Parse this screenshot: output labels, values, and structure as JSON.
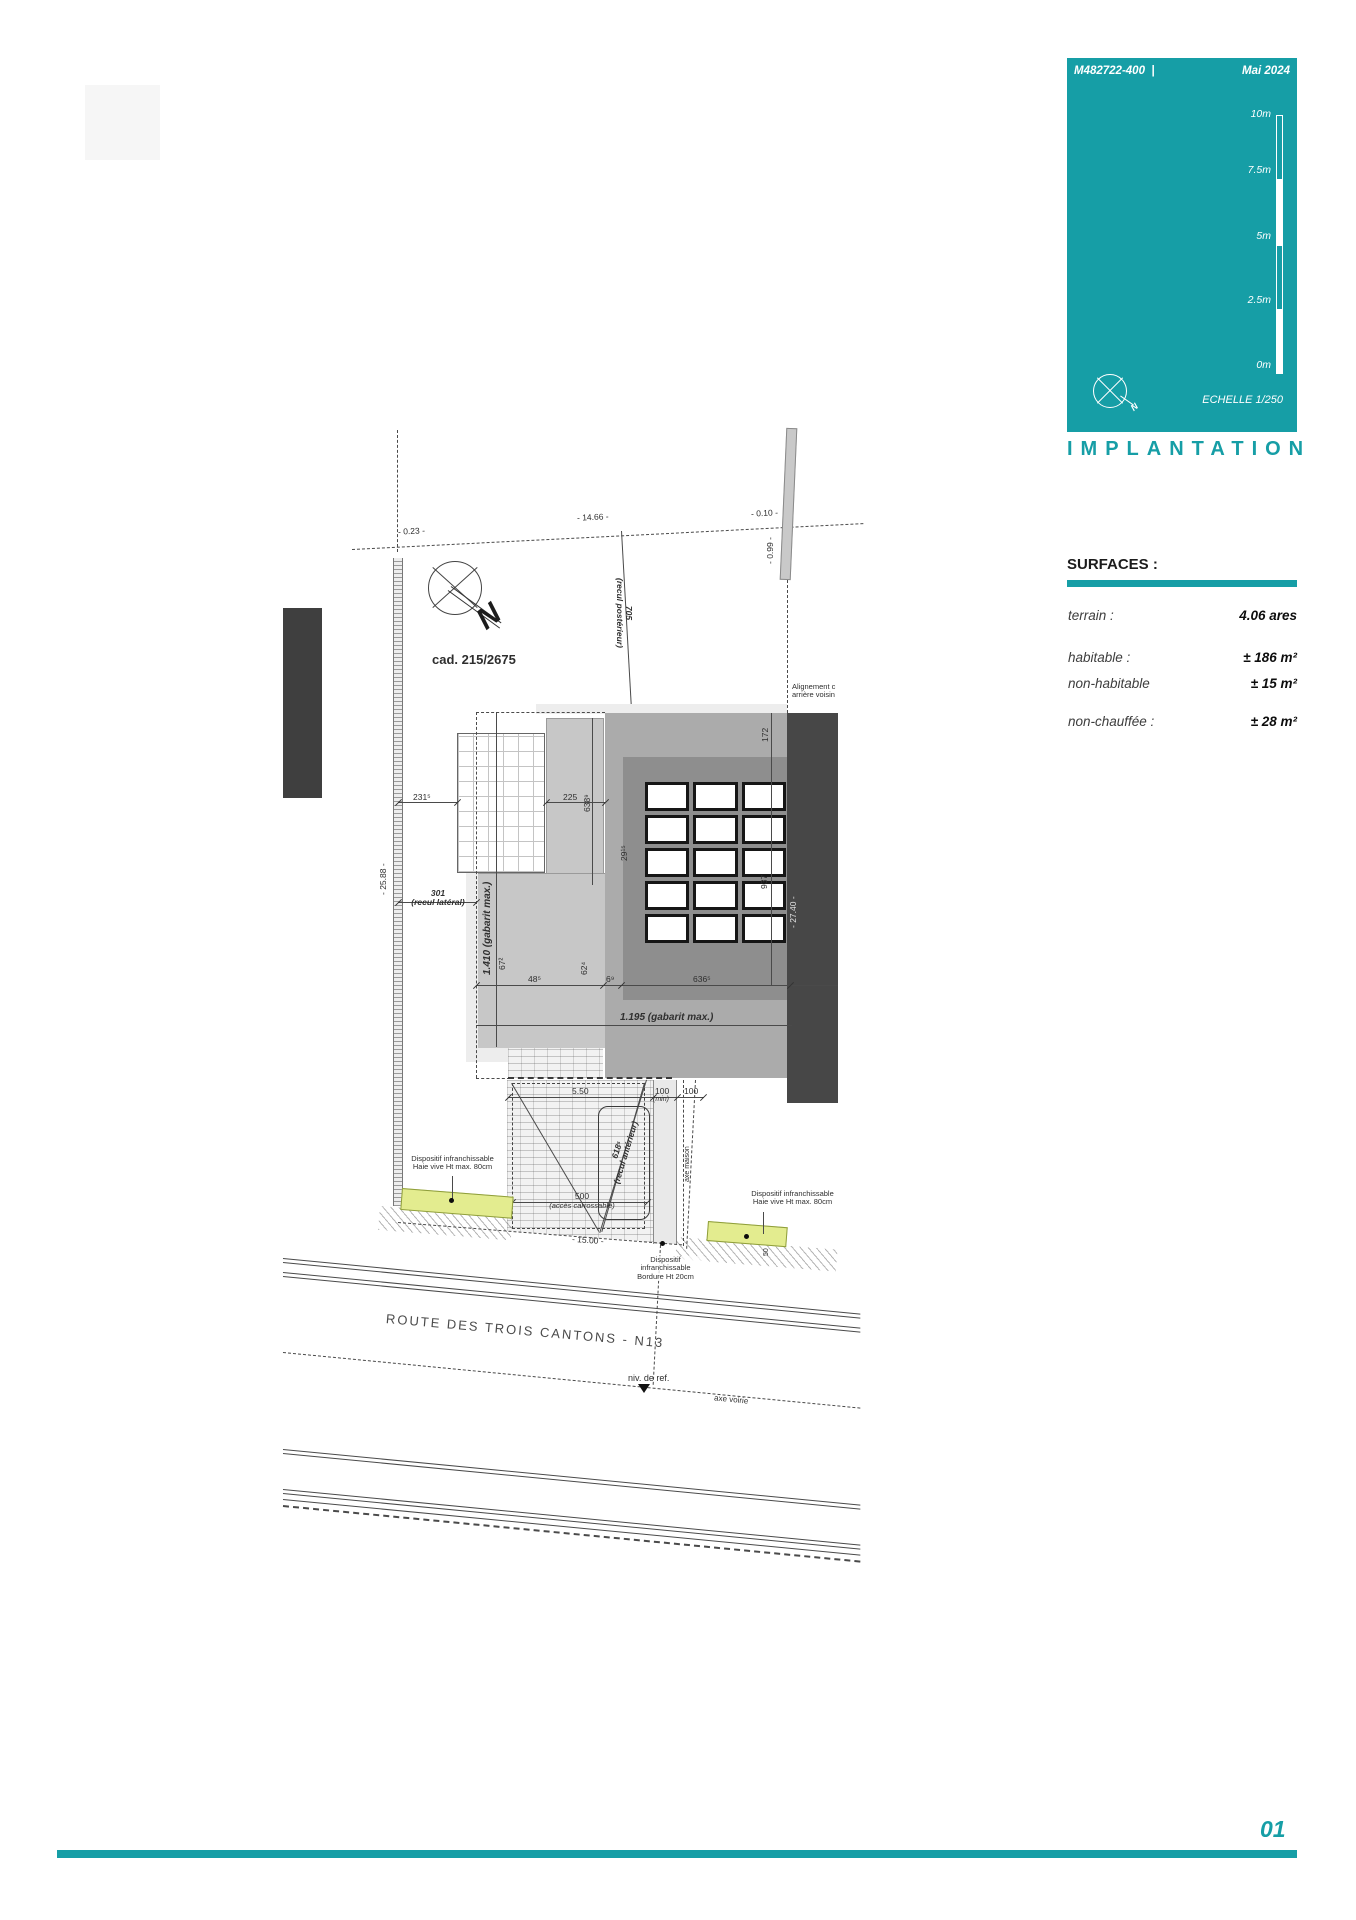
{
  "accent_color": "#169ea6",
  "header": {
    "ref": "M482722-400",
    "separator": "|",
    "date": "Mai 2024",
    "scale_label": "ECHELLE  1/250",
    "title": "IMPLANTATION",
    "page_number": "01"
  },
  "scale_bar": {
    "labels": [
      "10m",
      "7.5m",
      "5m",
      "2.5m",
      "0m"
    ]
  },
  "surfaces": {
    "heading": "SURFACES :",
    "rows": [
      {
        "label": "terrain :",
        "value": "4.06 ares"
      },
      {
        "label": "habitable :",
        "value": "± 186 m²"
      },
      {
        "label": "non-habitable",
        "value": "± 15 m²"
      },
      {
        "label": "non-chauffée :",
        "value": "± 28 m²"
      }
    ]
  },
  "plan": {
    "north_letter": "N",
    "cadastre": "cad. 215/2675",
    "d023": "- 0.23 -",
    "d1466": "- 14.66 -",
    "d010": "- 0.10 -",
    "d099": "- 0.99 -",
    "d2588": "- 25.88 -",
    "d705": "705",
    "recul_posterieur": "(recul postérieur)",
    "d2315": "231⁵",
    "d225": "225",
    "d6389": "638⁹",
    "d172": "172",
    "d937": "937",
    "d2740": "- 27.40 -",
    "d2915": "29¹⁵",
    "d301": "301",
    "recul_lateral": "(recul latéral)",
    "gabarit_1410": "1.410 (gabarit max.)",
    "d672": "67²",
    "d624": "62⁴",
    "d485": "48⁵",
    "d69": "6⁹",
    "d6365": "636⁵",
    "gabarit_1195": "1.195 (gabarit max.)",
    "alignement_1": "Alignement c",
    "alignement_2": "arrière voisin",
    "d550": "5.50",
    "d100a": "100",
    "d100a_min": "(min)",
    "d100b": "100",
    "d6185": "618⁵",
    "recul_anterieur": "(recul antérieur)",
    "axe_maison": "axe maison",
    "d500": "500",
    "acces_carrossable": "(accès carrossable)",
    "d1500": "- 15.00 -",
    "d50": "50",
    "dispositif_haie_1": "Dispositif infranchissable",
    "dispositif_haie_2": "Haie vive Ht max. 80cm",
    "dispositif_bordure_1": "Dispositif",
    "dispositif_bordure_2": "infranchissable",
    "dispositif_bordure_3": "Bordure Ht 20cm",
    "niv_ref": "niv. de ref.",
    "axe_voirie": "axe voirie",
    "road_name": "ROUTE DES TROIS CANTONS - N13"
  }
}
